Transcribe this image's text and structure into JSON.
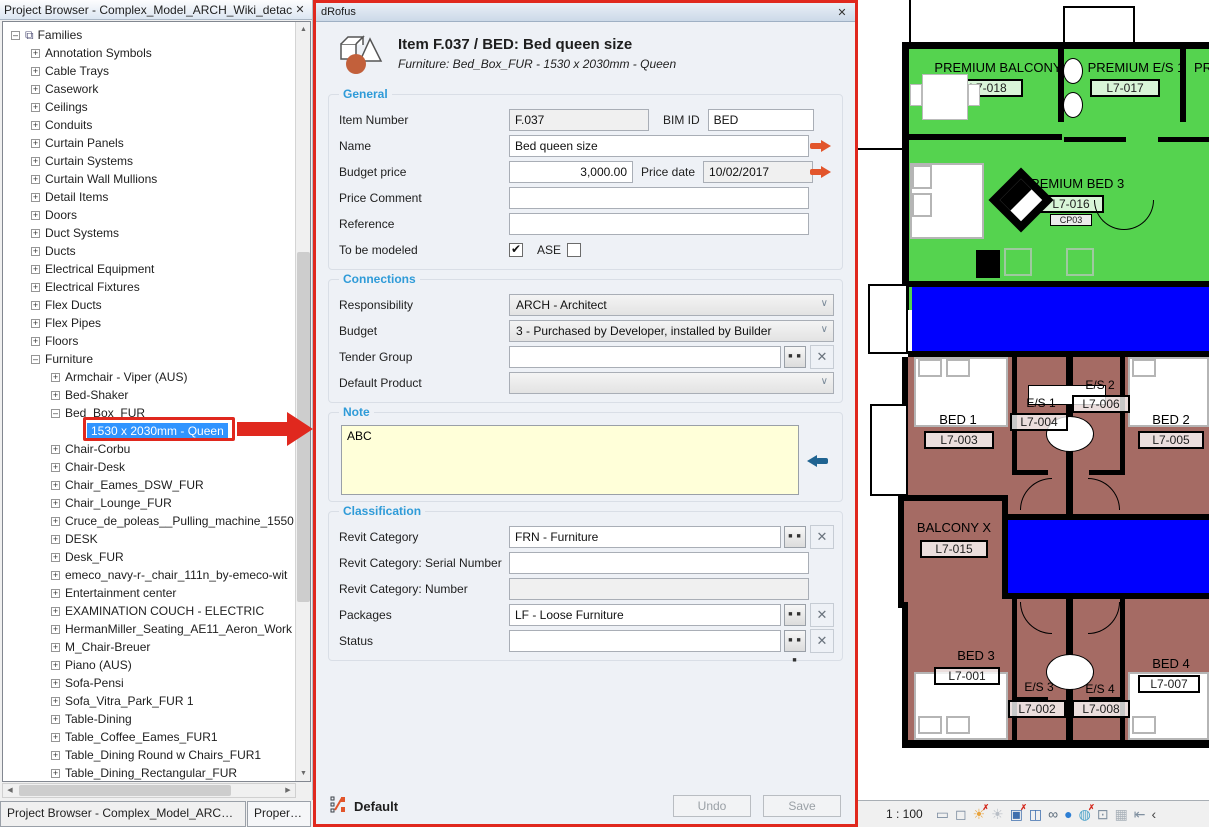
{
  "project_browser": {
    "title": "Project Browser - Complex_Model_ARCH_Wiki_detache...",
    "tree": {
      "items": [
        {
          "label": "Families",
          "level": 0,
          "exp": "minus",
          "root": true
        },
        {
          "label": "Annotation Symbols",
          "level": 1,
          "exp": "plus"
        },
        {
          "label": "Cable Trays",
          "level": 1,
          "exp": "plus"
        },
        {
          "label": "Casework",
          "level": 1,
          "exp": "plus"
        },
        {
          "label": "Ceilings",
          "level": 1,
          "exp": "plus"
        },
        {
          "label": "Conduits",
          "level": 1,
          "exp": "plus"
        },
        {
          "label": "Curtain Panels",
          "level": 1,
          "exp": "plus"
        },
        {
          "label": "Curtain Systems",
          "level": 1,
          "exp": "plus"
        },
        {
          "label": "Curtain Wall Mullions",
          "level": 1,
          "exp": "plus"
        },
        {
          "label": "Detail Items",
          "level": 1,
          "exp": "plus"
        },
        {
          "label": "Doors",
          "level": 1,
          "exp": "plus"
        },
        {
          "label": "Duct Systems",
          "level": 1,
          "exp": "plus"
        },
        {
          "label": "Ducts",
          "level": 1,
          "exp": "plus"
        },
        {
          "label": "Electrical Equipment",
          "level": 1,
          "exp": "plus"
        },
        {
          "label": "Electrical Fixtures",
          "level": 1,
          "exp": "plus"
        },
        {
          "label": "Flex Ducts",
          "level": 1,
          "exp": "plus"
        },
        {
          "label": "Flex Pipes",
          "level": 1,
          "exp": "plus"
        },
        {
          "label": "Floors",
          "level": 1,
          "exp": "plus"
        },
        {
          "label": "Furniture",
          "level": 1,
          "exp": "minus"
        },
        {
          "label": "Armchair - Viper (AUS)",
          "level": 2,
          "exp": "plus"
        },
        {
          "label": "Bed-Shaker",
          "level": 2,
          "exp": "plus"
        },
        {
          "label": "Bed_Box_FUR",
          "level": 2,
          "exp": "minus"
        },
        {
          "label": "1530 x 2030mm - Queen",
          "level": 3,
          "exp": "none",
          "selected": true
        },
        {
          "label": "Chair-Corbu",
          "level": 2,
          "exp": "plus"
        },
        {
          "label": "Chair-Desk",
          "level": 2,
          "exp": "plus"
        },
        {
          "label": "Chair_Eames_DSW_FUR",
          "level": 2,
          "exp": "plus"
        },
        {
          "label": "Chair_Lounge_FUR",
          "level": 2,
          "exp": "plus"
        },
        {
          "label": "Cruce_de_poleas__Pulling_machine_1550",
          "level": 2,
          "exp": "plus"
        },
        {
          "label": "DESK",
          "level": 2,
          "exp": "plus"
        },
        {
          "label": "Desk_FUR",
          "level": 2,
          "exp": "plus"
        },
        {
          "label": "emeco_navy-r-_chair_111n_by-emeco-wit",
          "level": 2,
          "exp": "plus"
        },
        {
          "label": "Entertainment center",
          "level": 2,
          "exp": "plus"
        },
        {
          "label": "EXAMINATION COUCH - ELECTRIC",
          "level": 2,
          "exp": "plus"
        },
        {
          "label": "HermanMiller_Seating_AE11_Aeron_Work",
          "level": 2,
          "exp": "plus"
        },
        {
          "label": "M_Chair-Breuer",
          "level": 2,
          "exp": "plus"
        },
        {
          "label": "Piano (AUS)",
          "level": 2,
          "exp": "plus"
        },
        {
          "label": "Sofa-Pensi",
          "level": 2,
          "exp": "plus"
        },
        {
          "label": "Sofa_Vitra_Park_FUR 1",
          "level": 2,
          "exp": "plus"
        },
        {
          "label": "Table-Dining",
          "level": 2,
          "exp": "plus"
        },
        {
          "label": "Table_Coffee_Eames_FUR1",
          "level": 2,
          "exp": "plus"
        },
        {
          "label": "Table_Dining Round w Chairs_FUR1",
          "level": 2,
          "exp": "plus"
        },
        {
          "label": "Table_Dining_Rectangular_FUR",
          "level": 2,
          "exp": "plus"
        }
      ]
    },
    "tabs": {
      "browser": "Project Browser - Complex_Model_ARCH_Wi...",
      "properties": "Properties"
    }
  },
  "drofus": {
    "window_title": "dRofus",
    "header_title": "Item F.037 / BED: Bed queen size",
    "header_subtitle": "Furniture: Bed_Box_FUR - 1530 x 2030mm - Queen",
    "general": {
      "label": "General",
      "item_number_label": "Item Number",
      "item_number": "F.037",
      "bim_id_label": "BIM ID",
      "bim_id": "BED",
      "name_label": "Name",
      "name": "Bed queen size",
      "budget_price_label": "Budget price",
      "budget_price": "3,000.00",
      "price_date_label": "Price date",
      "price_date": "10/02/2017",
      "price_comment_label": "Price Comment",
      "price_comment": "",
      "reference_label": "Reference",
      "reference": "",
      "to_be_modeled_label": "To be modeled",
      "to_be_modeled_checked": true,
      "ase_label": "ASE",
      "ase_checked": false
    },
    "connections": {
      "label": "Connections",
      "responsibility_label": "Responsibility",
      "responsibility": "ARCH - Architect",
      "budget_label": "Budget",
      "budget": "3 - Purchased by Developer, installed by Builder",
      "tender_group_label": "Tender Group",
      "tender_group": "",
      "default_product_label": "Default Product",
      "default_product": ""
    },
    "note": {
      "label": "Note",
      "text": "ABC"
    },
    "classification": {
      "label": "Classification",
      "revit_category_label": "Revit Category",
      "revit_category": "FRN - Furniture",
      "serial_number_label": "Revit Category: Serial Number",
      "serial_number": "",
      "number_label": "Revit Category: Number",
      "number": "",
      "packages_label": "Packages",
      "packages": "LF - Loose Furniture",
      "status_label": "Status",
      "status": ""
    },
    "footer": {
      "profile": "Default",
      "undo": "Undo",
      "save": "Save"
    }
  },
  "floor_plan": {
    "rooms": {
      "premium_balcony": {
        "name": "PREMIUM BALCONY",
        "tag": "L7-018"
      },
      "premium_es1": {
        "name": "PREMIUM E/S 1",
        "tag": "L7-017"
      },
      "premium_bed3": {
        "name": "PREMIUM BED 3",
        "tag": "L7-016",
        "control_tag": "CP03"
      },
      "partial_room_right": "PR",
      "bed1": {
        "name": "BED 1",
        "tag": "L7-003"
      },
      "es1": {
        "name": "E/S 1",
        "tag": "L7-004"
      },
      "es2": {
        "name": "E/S 2",
        "tag": "L7-006"
      },
      "bed2": {
        "name": "BED 2",
        "tag": "L7-005"
      },
      "balcony_x": {
        "name": "BALCONY X",
        "tag": "L7-015"
      },
      "bed3": {
        "name": "BED 3",
        "tag": "L7-001"
      },
      "es3": {
        "name": "E/S 3",
        "tag": "L7-002"
      },
      "es4": {
        "name": "E/S 4",
        "tag": "L7-008"
      },
      "bed4": {
        "name": "BED 4",
        "tag": "L7-007"
      }
    },
    "view_bar": {
      "scale": "1 : 100",
      "icons": [
        {
          "name": "detail-level-icon",
          "glyph": "▭",
          "color": "#7c8ca0"
        },
        {
          "name": "visual-style-icon",
          "glyph": "◻",
          "color": "#7c8ca0"
        },
        {
          "name": "sun-path-icon",
          "glyph": "☀",
          "color": "#e8a33d",
          "overlay": "✗"
        },
        {
          "name": "shadows-icon",
          "glyph": "☀",
          "color": "#b8bec6"
        },
        {
          "name": "crop-view-icon",
          "glyph": "▣",
          "color": "#3f6fae",
          "overlay": "✗"
        },
        {
          "name": "show-crop-region-icon",
          "glyph": "◫",
          "color": "#3f6fae"
        },
        {
          "name": "temporary-hide-isolate-icon",
          "glyph": "∞",
          "color": "#5a6a7a"
        },
        {
          "name": "reveal-hidden-elements-icon",
          "glyph": "●",
          "color": "#2e7fd4"
        },
        {
          "name": "worksharing-display-icon",
          "glyph": "◍",
          "color": "#4aa0c8",
          "overlay": "✗"
        },
        {
          "name": "temporary-view-properties-icon",
          "glyph": "⊡",
          "color": "#8090a0"
        },
        {
          "name": "analytical-model-icon",
          "glyph": "▦",
          "color": "#a8b0b8"
        },
        {
          "name": "reveal-constraints-icon",
          "glyph": "⇤",
          "color": "#8090a0"
        },
        {
          "name": "collapse-chevron-icon",
          "glyph": "‹",
          "color": "#444444"
        }
      ]
    }
  },
  "colors": {
    "room_green": "#55d34f",
    "room_blue": "#0000ff",
    "room_brown": "#a56b64",
    "annotation_red": "#e0281e",
    "selection_blue": "#3094ff",
    "accent_blue": "#2f9bd8",
    "note_yellow": "#ffffd9",
    "arrow_orange": "#e2552b",
    "arrow_blue": "#1f6391"
  }
}
